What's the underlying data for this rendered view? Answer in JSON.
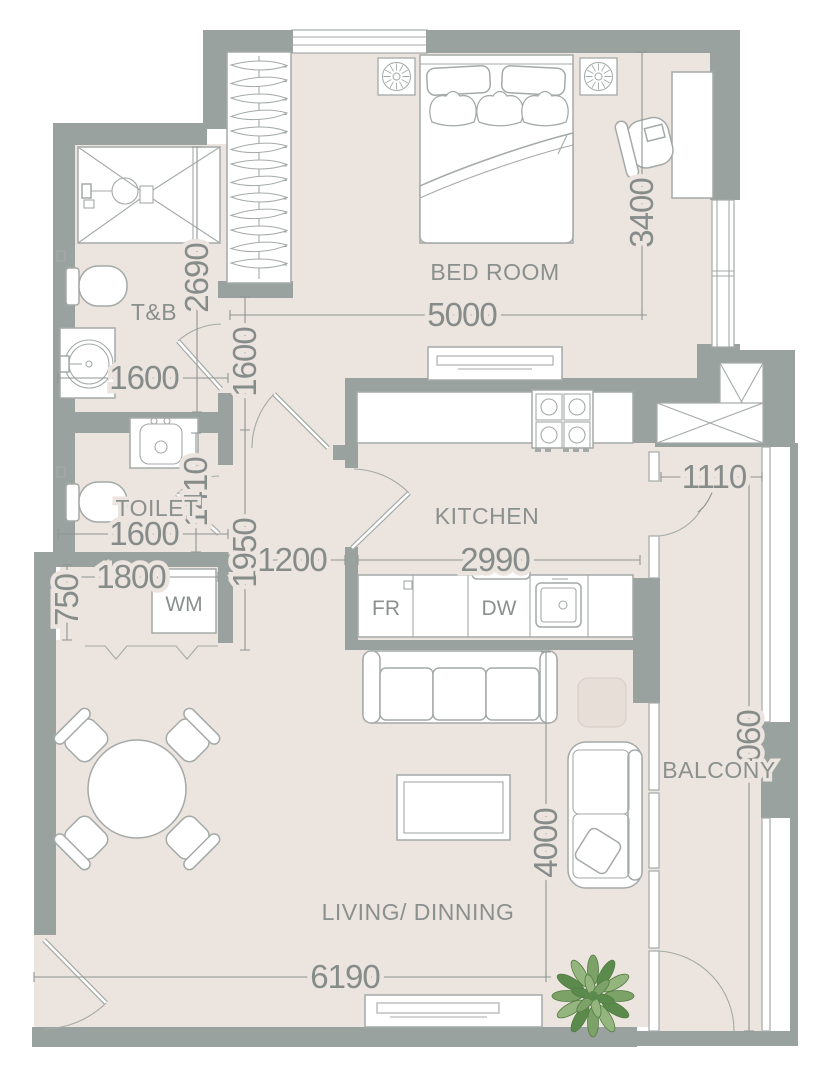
{
  "palette": {
    "floor": "#ece4de",
    "wall": "#9aa29f",
    "furniture_line": "#a4aaa7",
    "dimension_text": "#858c8a",
    "label_text": "#8a908e",
    "white": "#ffffff",
    "plant_dark": "#5b8a4d",
    "plant_mid": "#7ca268",
    "plant_light": "#94b57e",
    "side_table": "#e7ded7"
  },
  "rooms": {
    "bedroom": {
      "label": "BED ROOM",
      "width_mm": "5000",
      "depth_mm": "3400"
    },
    "bath": {
      "label": "T&B",
      "height_mm": "2690",
      "width_mm": "1600"
    },
    "toilet": {
      "label": "TOILET",
      "depth_mm": "1410",
      "width_mm": "1600"
    },
    "kitchen": {
      "label": "KITCHEN",
      "width_mm": "2990"
    },
    "balcony": {
      "label": "BALCONY",
      "door_mm": "1110",
      "length_mm": "6060"
    },
    "living": {
      "label": "LIVING/ DINNING",
      "depth_mm": "4000",
      "width_mm": "6190"
    },
    "hallway": {
      "upper_mm": "1600",
      "lower_mm": "1950",
      "width_mm": "1200"
    },
    "closet": {
      "width_mm": "1800",
      "depth_mm": "750"
    }
  },
  "appliances": {
    "washing_machine": "WM",
    "fridge": "FR",
    "dishwasher": "DW"
  }
}
